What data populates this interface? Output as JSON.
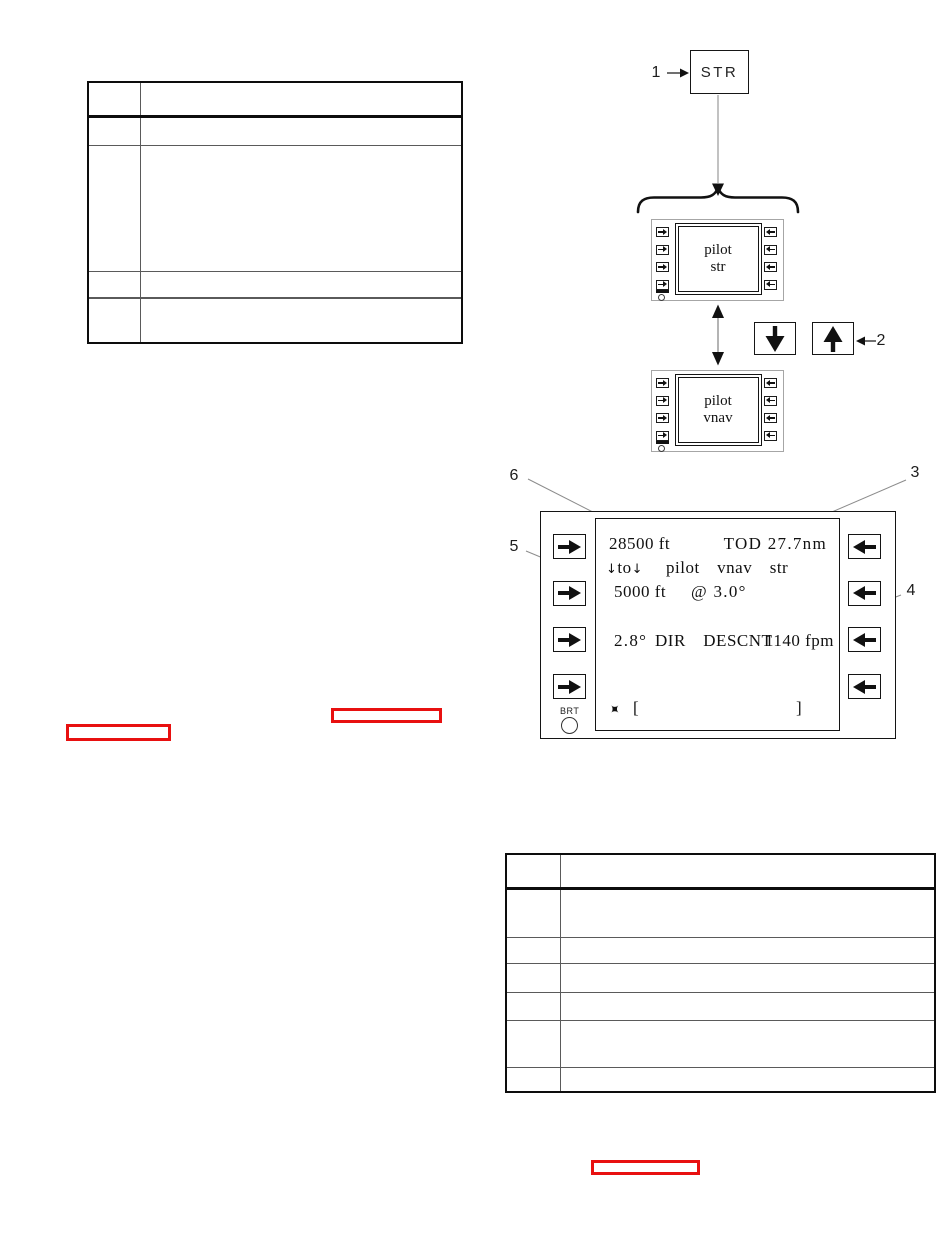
{
  "figure": {
    "callouts": {
      "c1": "1",
      "c2": "2",
      "c3": "3",
      "c4": "4",
      "c5": "5",
      "c6": "6"
    },
    "str_key_label": "STR",
    "display_top": {
      "line1": "pilot",
      "line2": "str"
    },
    "display_bottom": {
      "line1": "pilot",
      "line2": "vnav"
    },
    "screen": {
      "current_altitude": "28500 ft",
      "tod_distance": "TOD 27.7nm",
      "to_arrow_left": "↓",
      "to_word": "to",
      "to_arrow_right": "↓",
      "mode_labels": "pilot  vnav  str",
      "target_altitude": "5000 ft",
      "flight_path_angle": "@ 3.0°",
      "descent_angle": "2.8°",
      "descent_mode": "DIR  DESCNT",
      "descent_rate": "1140 fpm",
      "aircraft_symbol": "✦",
      "bracket_open": "[",
      "bracket_close": "]",
      "brt_label": "BRT"
    }
  },
  "colors": {
    "link_hotspot_red": "#e81010",
    "ink_black": "#111111",
    "bezel_gray": "#a6a6a6",
    "line_gray": "#8c8c8c"
  },
  "tables": {
    "top_left": {
      "columns": 2,
      "rows": 5,
      "cells": []
    },
    "bottom_right": {
      "columns": 2,
      "rows": 7,
      "cells": []
    }
  }
}
